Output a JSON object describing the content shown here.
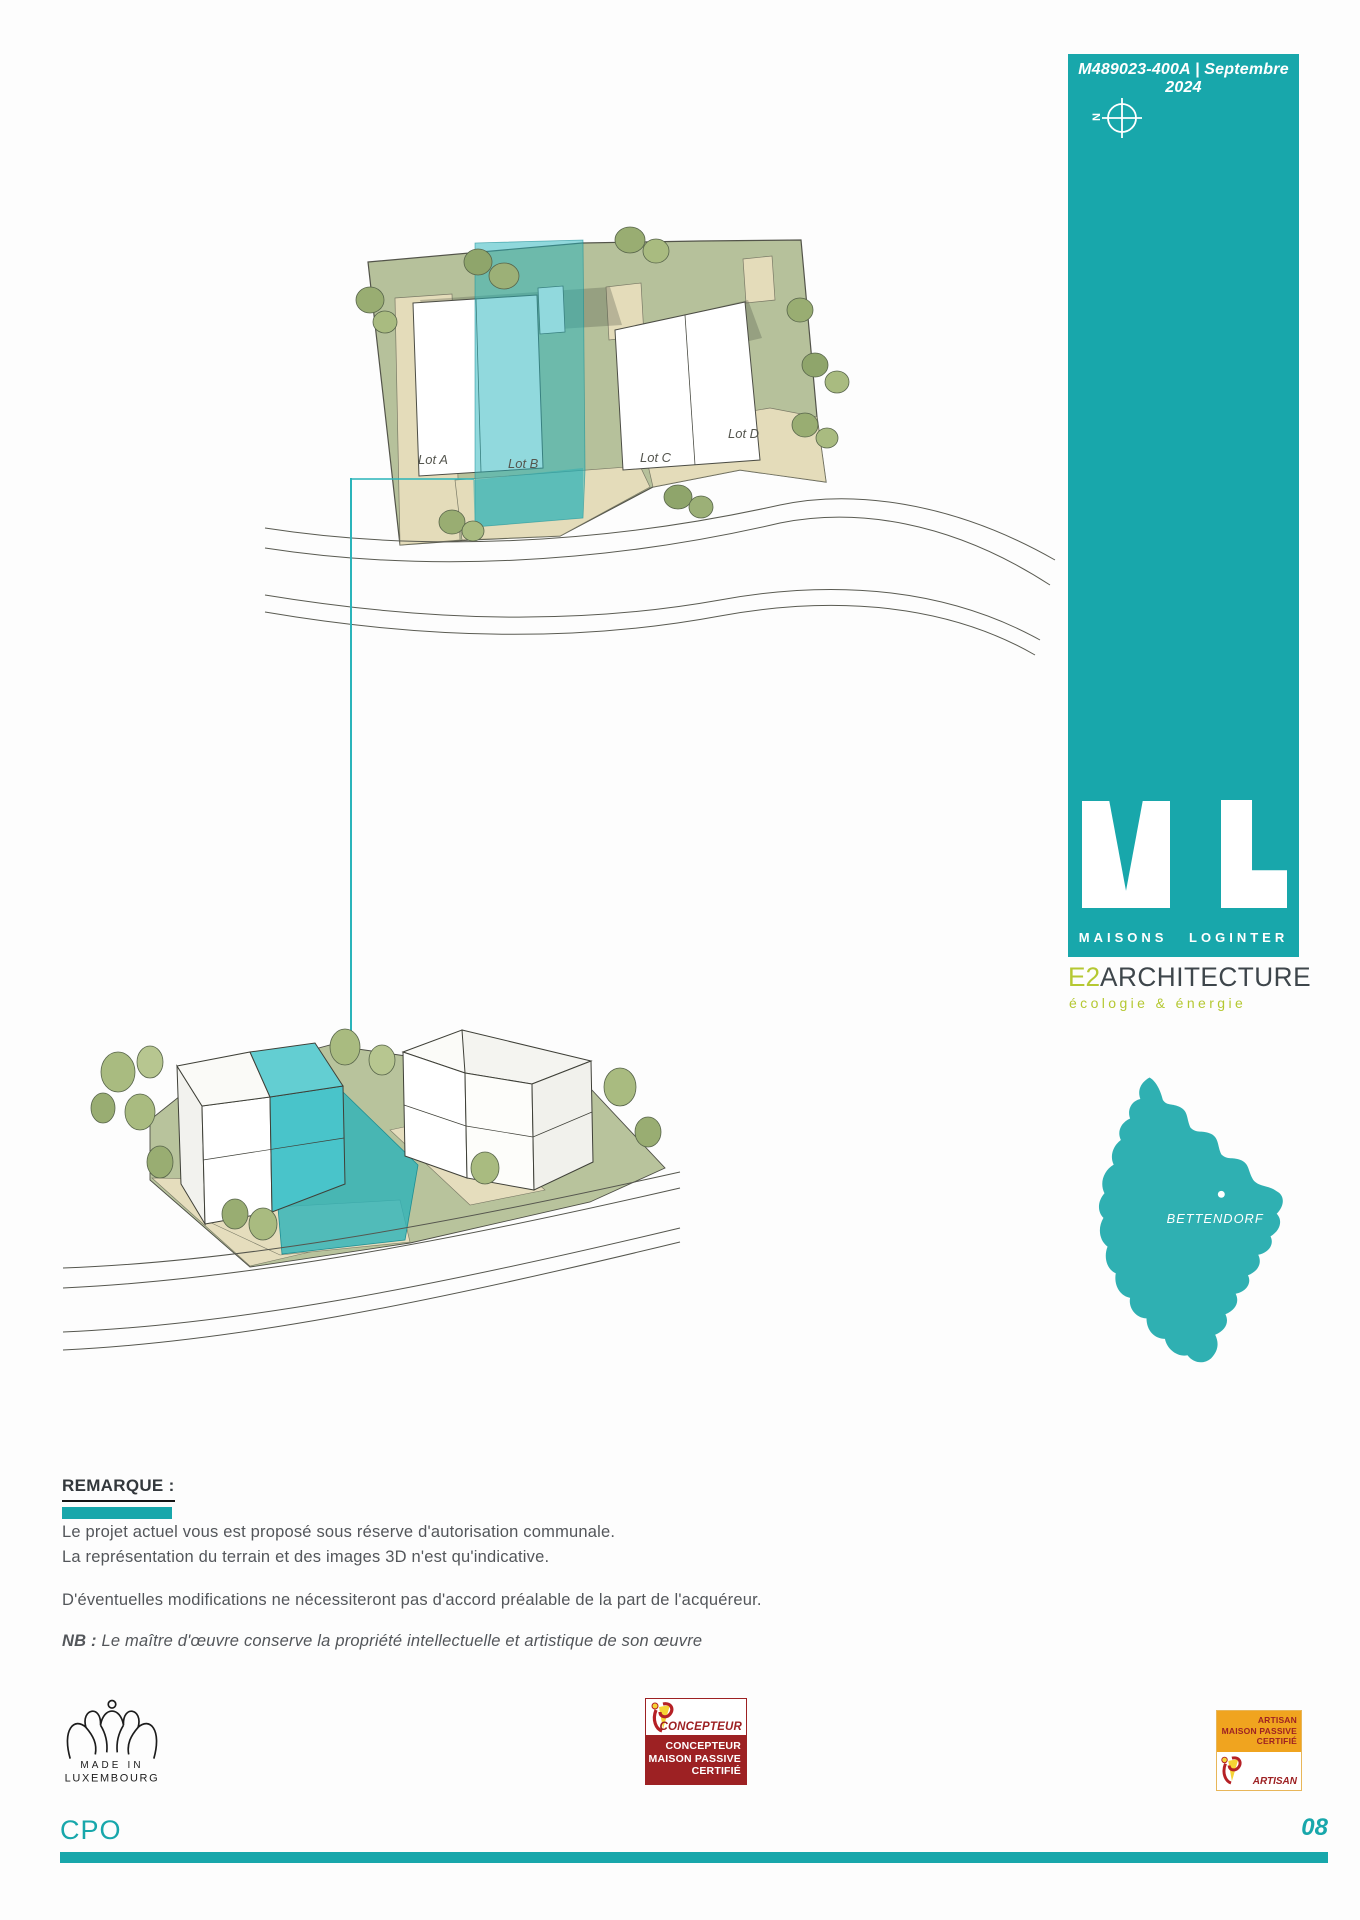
{
  "sheet": {
    "reference": "M489023-400A",
    "divider": "|",
    "date": "Septembre 2024",
    "code": "CPO",
    "page": "08"
  },
  "compass": {
    "north": "N"
  },
  "brand": {
    "wordmark": "MAISONS LOGINTER"
  },
  "architect": {
    "prefix": "E2",
    "name": "ARCHITECTURE",
    "tagline": "écologie & énergie"
  },
  "map": {
    "town": "BETTENDORF"
  },
  "plan": {
    "lot_a": "Lot A",
    "lot_b": "Lot B",
    "lot_c": "Lot C",
    "lot_d": "Lot D"
  },
  "remark": {
    "title": "REMARQUE :",
    "line1": "Le projet actuel vous est proposé sous réserve d'autorisation communale.",
    "line2": "La représentation du terrain et des images  3D n'est qu'indicative.",
    "line3": "D'éventuelles modifications ne nécessiteront pas d'accord préalable de la part de l'acquéreur.",
    "nb_label": "NB :",
    "nb_text": " Le maître d'œuvre conserve la propriété intellectuelle et artistique de son œuvre"
  },
  "badges": {
    "made_in": {
      "line1": "MADE IN",
      "line2": "LUXEMBOURG"
    },
    "concepteur": {
      "header": "CONCEPTEUR",
      "line1": "CONCEPTEUR",
      "line2": "MAISON PASSIVE",
      "line3": "CERTIFIÉ"
    },
    "artisan": {
      "line1": "ARTISAN",
      "line2": "MAISON PASSIVE",
      "line3": "CERTIFIÉ",
      "footer": "ARTISAN"
    }
  },
  "colors": {
    "teal": "#18a7ab",
    "lime": "#b5c832",
    "badge_red": "#9d2123",
    "badge_orange": "#f0a41f",
    "highlight": "#2ab4ba"
  }
}
